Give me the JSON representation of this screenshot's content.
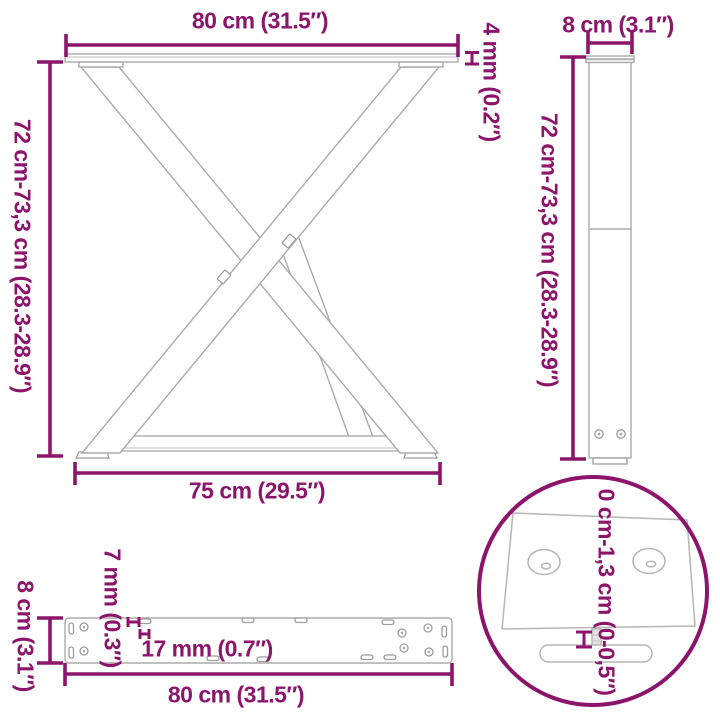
{
  "colors": {
    "accent": "#8C156B",
    "line": "#ABABAB",
    "line_soft": "#C9C9C9",
    "background": "#FFFFFF"
  },
  "views": {
    "front_view": {
      "top_width_label": "80 cm (31.5″)",
      "plate_thickness_label": "4 mm (0.2″)",
      "height_label": "72 cm-73,3 cm (28.3-28.9″)",
      "bottom_width_label": "75 cm (29.5″)"
    },
    "side_view": {
      "depth_label": "8 cm (3.1″)",
      "height_label": "72 cm-73,3 cm (28.3-28.9″)"
    },
    "mounting_plate_top_view": {
      "depth_label": "8 cm (3.1″)",
      "hole_diameter_label": "7 mm (0.3″)",
      "hole_spacing_label": "17 mm (0.7″)",
      "length_label": "80 cm (31.5″)"
    },
    "foot_detail_view": {
      "adjustable_height_label": "0 cm-1,3 cm (0-0,5″)"
    }
  }
}
